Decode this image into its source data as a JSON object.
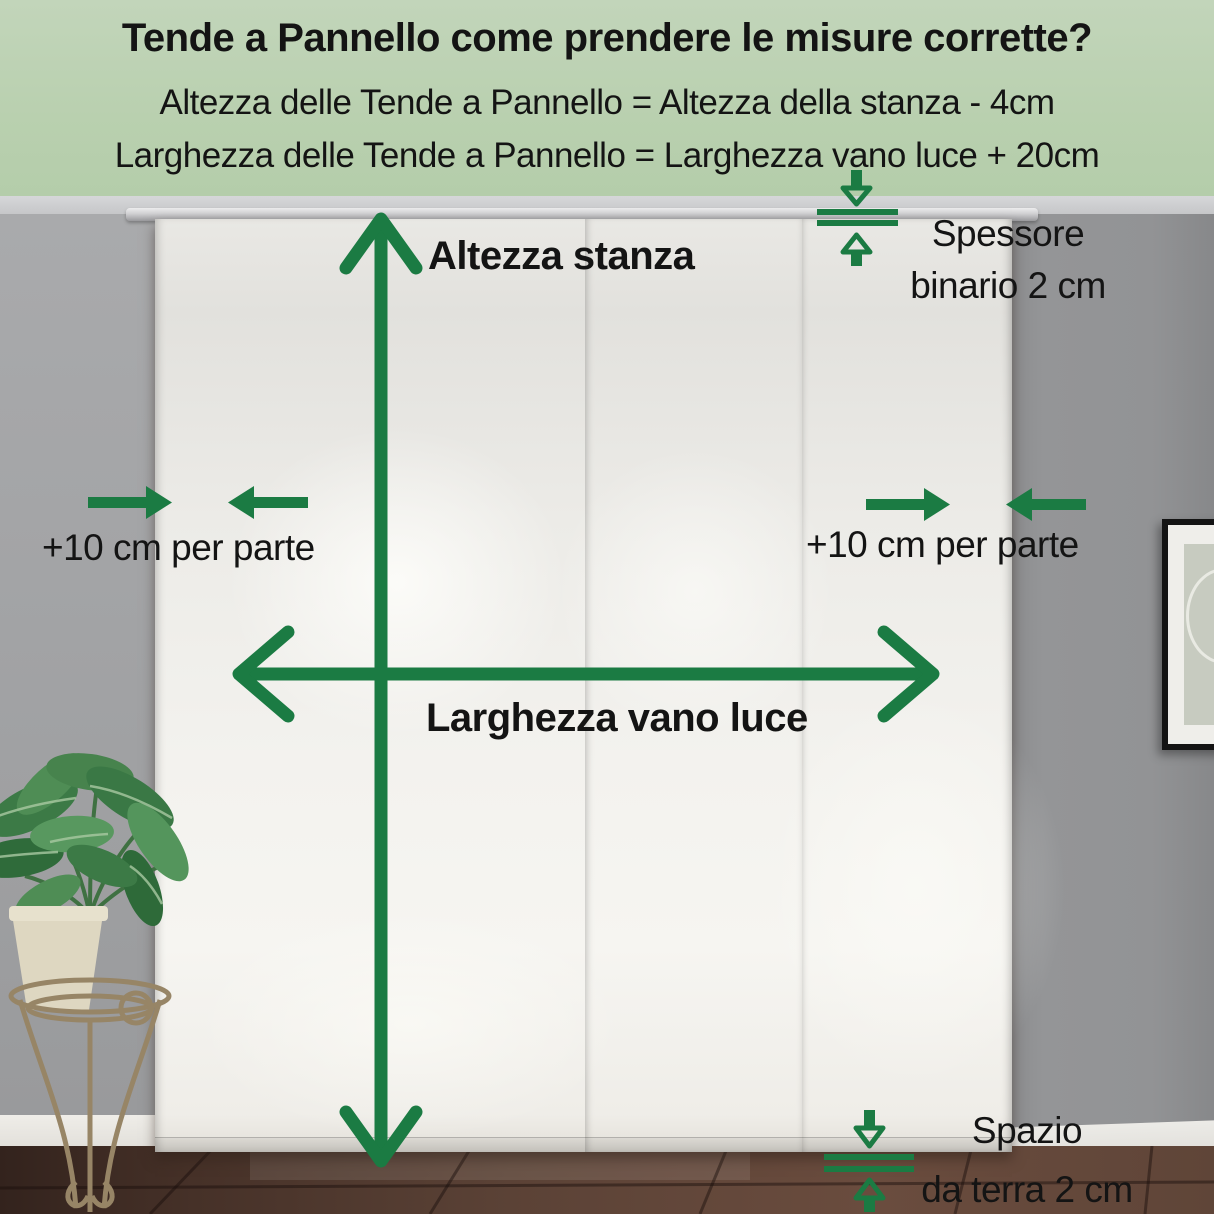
{
  "header": {
    "title": "Tende a Pannello come prendere le misure corrette?",
    "formula_height": "Altezza delle Tende a Pannello = Altezza della stanza - 4cm",
    "formula_width": "Larghezza delle Tende a Pannello = Larghezza vano luce + 20cm"
  },
  "annotations": {
    "room_height_label": "Altezza stanza",
    "window_width_label": "Larghezza vano luce",
    "side_allowance_left_label": "+10 cm per parte",
    "side_allowance_right_label": "+10 cm per parte",
    "track_thickness_line1": "Spessore",
    "track_thickness_line2": "binario 2 cm",
    "floor_gap_line1": "Spazio",
    "floor_gap_line2": "da terra 2 cm"
  },
  "colors": {
    "annotation_green": "#1b7b43",
    "header_background": "#b9d0af",
    "text": "#141414",
    "wall_gray": "#9b9c9e",
    "curtain_white": "#f2f1ed",
    "floor_brown": "#5b4236"
  }
}
